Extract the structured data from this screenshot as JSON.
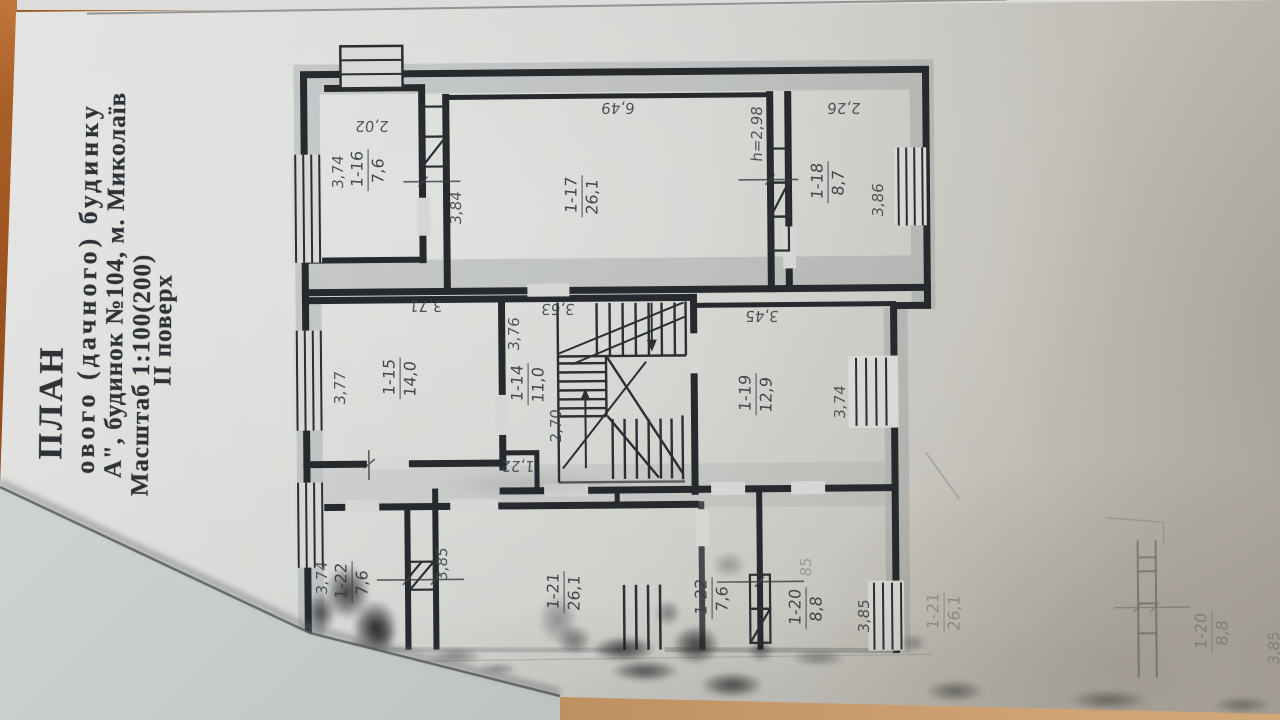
{
  "document": {
    "kind": "photographed floor plan sheet",
    "title_block": {
      "heading": "ПЛАН",
      "line2": "ового (дачного) будинку",
      "line3": "А\", будинок №104, м. Миколаїв",
      "line4": "Масштаб 1:100(200)",
      "floor": "ІІ поверх"
    }
  },
  "plan": {
    "rooms": [
      {
        "number": "1-16",
        "area": "7,6",
        "cx": 368,
        "cy": 170
      },
      {
        "number": "1-17",
        "area": "26,1",
        "cx": 582,
        "cy": 196
      },
      {
        "number": "1-18",
        "area": "8,7",
        "cx": 828,
        "cy": 182
      },
      {
        "number": "1-15",
        "area": "14,0",
        "cx": 400,
        "cy": 378
      },
      {
        "number": "1-14",
        "area": "11,0",
        "cx": 528,
        "cy": 384
      },
      {
        "number": "1-19",
        "area": "12,9",
        "cx": 756,
        "cy": 394
      },
      {
        "number": "1-22",
        "area": "7,6",
        "cx": 352,
        "cy": 582
      },
      {
        "number": "1-21",
        "area": "26,1",
        "cx": 564,
        "cy": 592
      },
      {
        "number": "1-22",
        "area": "7,6",
        "cx": 712,
        "cy": 598
      },
      {
        "number": "1-20",
        "area": "8,8",
        "cx": 806,
        "cy": 608
      }
    ],
    "ghost_rooms": [
      {
        "number": "1-21",
        "area": "26,1",
        "cx": 944,
        "cy": 612
      },
      {
        "number": "1-20",
        "area": "8,8",
        "cx": 1212,
        "cy": 632
      }
    ],
    "dimensions": [
      {
        "text": "2,02",
        "cx": 372,
        "cy": 126,
        "orient": "flip"
      },
      {
        "text": "6,49",
        "cx": 618,
        "cy": 108,
        "orient": "flip"
      },
      {
        "text": "2,26",
        "cx": 844,
        "cy": 108,
        "orient": "flip"
      },
      {
        "text": "3,71",
        "cx": 426,
        "cy": 306,
        "orient": "flip"
      },
      {
        "text": "3,63",
        "cx": 558,
        "cy": 309,
        "orient": "flip"
      },
      {
        "text": "3,45",
        "cx": 762,
        "cy": 316,
        "orient": "flip"
      },
      {
        "text": "1,22",
        "cx": 518,
        "cy": 466,
        "orient": "flip"
      },
      {
        "text": "3,74",
        "cx": 338,
        "cy": 172,
        "orient": "v"
      },
      {
        "text": "3,84",
        "cx": 456,
        "cy": 208,
        "orient": "v"
      },
      {
        "text": "h=2,98",
        "cx": 757,
        "cy": 134,
        "orient": "v"
      },
      {
        "text": "3,86",
        "cx": 878,
        "cy": 200,
        "orient": "v"
      },
      {
        "text": "3,77",
        "cx": 340,
        "cy": 388,
        "orient": "v"
      },
      {
        "text": "3,76",
        "cx": 514,
        "cy": 334,
        "orient": "v"
      },
      {
        "text": "2,70",
        "cx": 556,
        "cy": 426,
        "orient": "v"
      },
      {
        "text": "3,74",
        "cx": 840,
        "cy": 402,
        "orient": "v"
      },
      {
        "text": "3,74",
        "cx": 322,
        "cy": 578,
        "orient": "v"
      },
      {
        "text": "3,85",
        "cx": 442,
        "cy": 564,
        "orient": "v"
      },
      {
        "text": "3,85",
        "cx": 864,
        "cy": 616,
        "orient": "v"
      },
      {
        "text": "85",
        "cx": 806,
        "cy": 567,
        "orient": "v",
        "faint": true
      },
      {
        "text": "3,85",
        "cx": 1274,
        "cy": 648,
        "orient": "v",
        "faint": true
      }
    ]
  },
  "colors": {
    "desk": "#b98a55",
    "desk_edge": "#a85f28",
    "paper": "#d6d8d5",
    "ink": "#26292d",
    "gray_sheet": "#c2c6c3"
  }
}
